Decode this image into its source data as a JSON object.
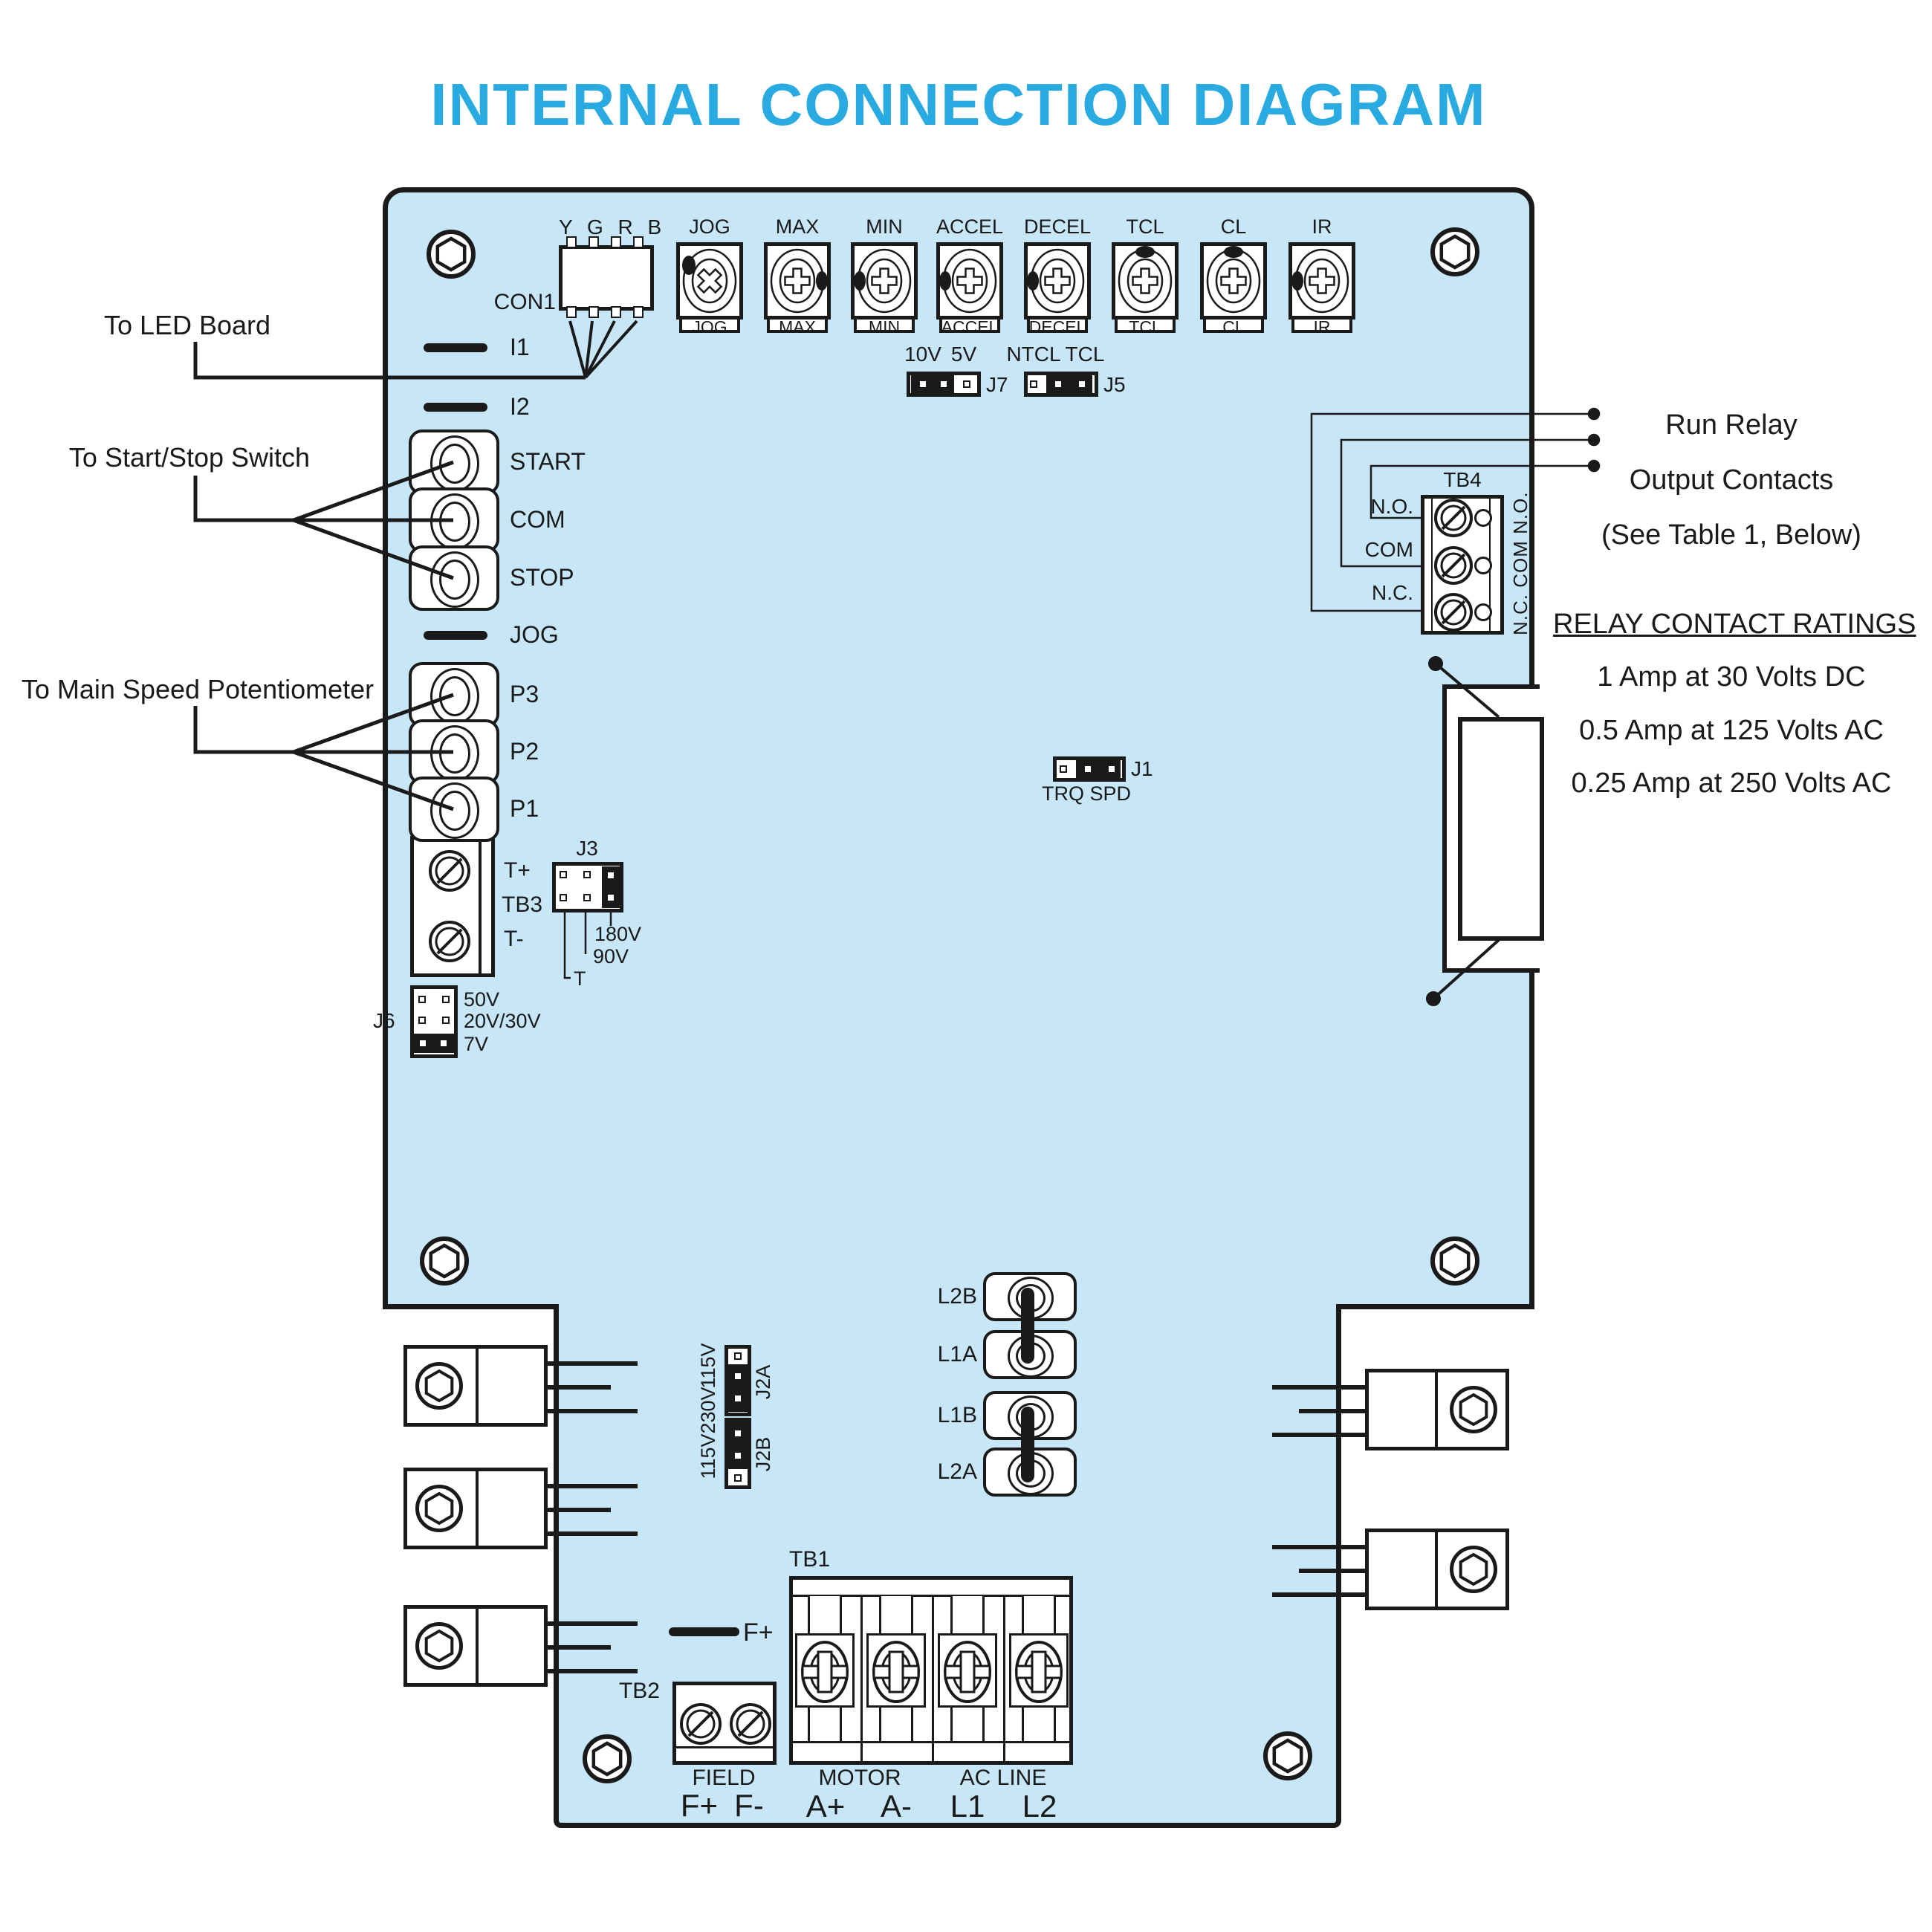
{
  "title": "INTERNAL CONNECTION DIAGRAM",
  "colors": {
    "board_fill": "#c7e7f8",
    "title": "#29abe2",
    "line": "#1a1a1a"
  },
  "annotations": {
    "to_led_board": "To LED Board",
    "to_start_stop": "To Start/Stop Switch",
    "to_main_speed": "To Main Speed Potentiometer"
  },
  "con1": {
    "label": "CON1",
    "pins": "Y G R B"
  },
  "pots": [
    "JOG",
    "MAX",
    "MIN",
    "ACCEL",
    "DECEL",
    "TCL",
    "CL",
    "IR"
  ],
  "left_io": {
    "i1": "I1",
    "i2": "I2",
    "start": "START",
    "com": "COM",
    "stop": "STOP",
    "jog": "JOG",
    "p3": "P3",
    "p2": "P2",
    "p1": "P1"
  },
  "jumpers": {
    "j7": {
      "name": "J7",
      "left": "10V",
      "right": "5V"
    },
    "j5": {
      "name": "J5",
      "left": "NTCL",
      "right": "TCL"
    },
    "j1": {
      "name": "J1",
      "sublabel": "TRQ SPD"
    },
    "j3": {
      "name": "J3",
      "opt1": "180V",
      "opt2": "90V",
      "opt3": "T"
    },
    "j6": {
      "name": "J6",
      "opt1": "50V",
      "opt2": "20V/30V",
      "opt3": "7V"
    },
    "j2a": {
      "name": "J2A"
    },
    "j2b": {
      "name": "J2B"
    },
    "j2_voltages": [
      "115V",
      "230V",
      "115V"
    ]
  },
  "tb3": {
    "name": "TB3",
    "plus": "T+",
    "minus": "T-"
  },
  "tb4": {
    "name": "TB4",
    "no": "N.O.",
    "com": "COM",
    "nc": "N.C.",
    "side_text": "N.C. COM N.O."
  },
  "relay": {
    "line1": "Run Relay",
    "line2": "Output Contacts",
    "line3": "(See Table 1, Below)",
    "ratings_title": "RELAY CONTACT RATINGS",
    "rating1": "1 Amp at 30 Volts DC",
    "rating2": "0.5 Amp at 125 Volts AC",
    "rating3": "0.25 Amp at 250 Volts AC"
  },
  "fuses": [
    "L2B",
    "L1A",
    "L1B",
    "L2A"
  ],
  "tb2": {
    "name": "TB2",
    "group": "FIELD",
    "fplus": "F+",
    "fminus": "F-",
    "fplus_mid": "F+"
  },
  "tb1": {
    "name": "TB1",
    "motor": "MOTOR",
    "acline": "AC LINE",
    "aplus": "A+",
    "aminus": "A-",
    "l1": "L1",
    "l2": "L2"
  }
}
